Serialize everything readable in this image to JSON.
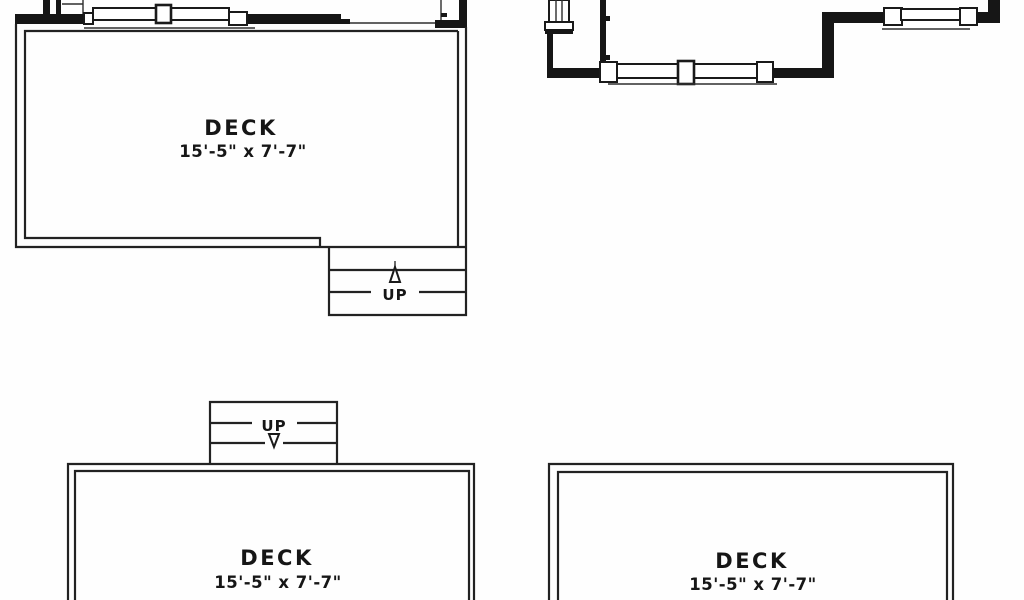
{
  "canvas": {
    "background": "#fefefe",
    "ink": "#1a1a1a"
  },
  "plans": {
    "upper_deck": {
      "label": "DECK",
      "dimensions": "15'-5\" x 7'-7\"",
      "stairs_label": "UP",
      "stairs_direction": "up"
    },
    "lower_left_deck": {
      "label": "DECK",
      "dimensions": "15'-5\" x 7'-7\"",
      "stairs_label": "UP",
      "stairs_direction": "down"
    },
    "lower_right_deck": {
      "label": "DECK",
      "dimensions": "15'-5\" x 7'-7\""
    }
  }
}
